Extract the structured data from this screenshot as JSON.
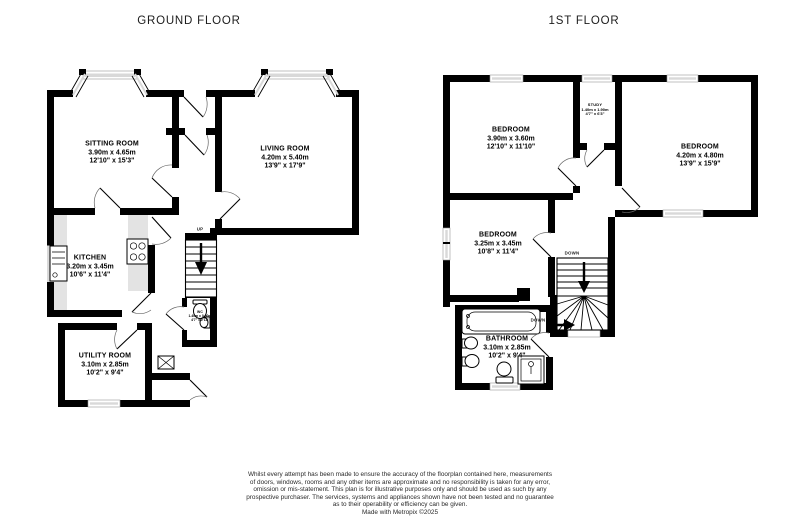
{
  "ground_floor": {
    "title": "GROUND FLOOR",
    "rooms": [
      {
        "name": "SITTING ROOM",
        "metric": "3.90m x 4.65m",
        "imperial": "12'10\" x 15'3\""
      },
      {
        "name": "LIVING ROOM",
        "metric": "4.20m x 5.40m",
        "imperial": "13'9\" x 17'9\""
      },
      {
        "name": "KITCHEN",
        "metric": "3.20m x 3.45m",
        "imperial": "10'6\" x 11'4\""
      },
      {
        "name": "UTILITY ROOM",
        "metric": "3.10m x 2.85m",
        "imperial": "10'2\" x 9'4\""
      },
      {
        "name": "WC",
        "metric": "1.40m x 0.90m",
        "imperial": "4'7\" x 2'11\""
      }
    ],
    "stairs_up_label": "UP"
  },
  "first_floor": {
    "title": "1ST FLOOR",
    "rooms": [
      {
        "name": "BEDROOM",
        "metric": "3.90m x 3.60m",
        "imperial": "12'10\" x 11'10\""
      },
      {
        "name": "STUDY",
        "metric": "1.40m x 1.90m",
        "imperial": "4'7\" x 6'3\""
      },
      {
        "name": "BEDROOM",
        "metric": "4.20m x 4.80m",
        "imperial": "13'9\" x 15'9\""
      },
      {
        "name": "BEDROOM",
        "metric": "3.25m x 3.45m",
        "imperial": "10'8\" x 11'4\""
      },
      {
        "name": "BATHROOM",
        "metric": "3.10m x 2.85m",
        "imperial": "10'2\" x 9'4\""
      }
    ],
    "stairs_down_label_1": "DOWN",
    "stairs_down_label_2": "DOWN"
  },
  "footer": {
    "lines": [
      "Whilst every attempt has been made to ensure the accuracy of the floorplan contained here, measurements",
      "of doors, windows, rooms and any other items are approximate and no responsibility is taken for any error,",
      "omission or mis-statement. This plan is for illustrative purposes only and should be used as such by any",
      "prospective purchaser. The services, systems and appliances shown have not been tested and no guarantee",
      "as to their operability or efficiency can be given.",
      "Made with Metropix ©2025"
    ]
  },
  "colors": {
    "wall": "#000000",
    "window_glass": "#d9d9d9",
    "kitchen_counter": "#e3e3e3"
  }
}
